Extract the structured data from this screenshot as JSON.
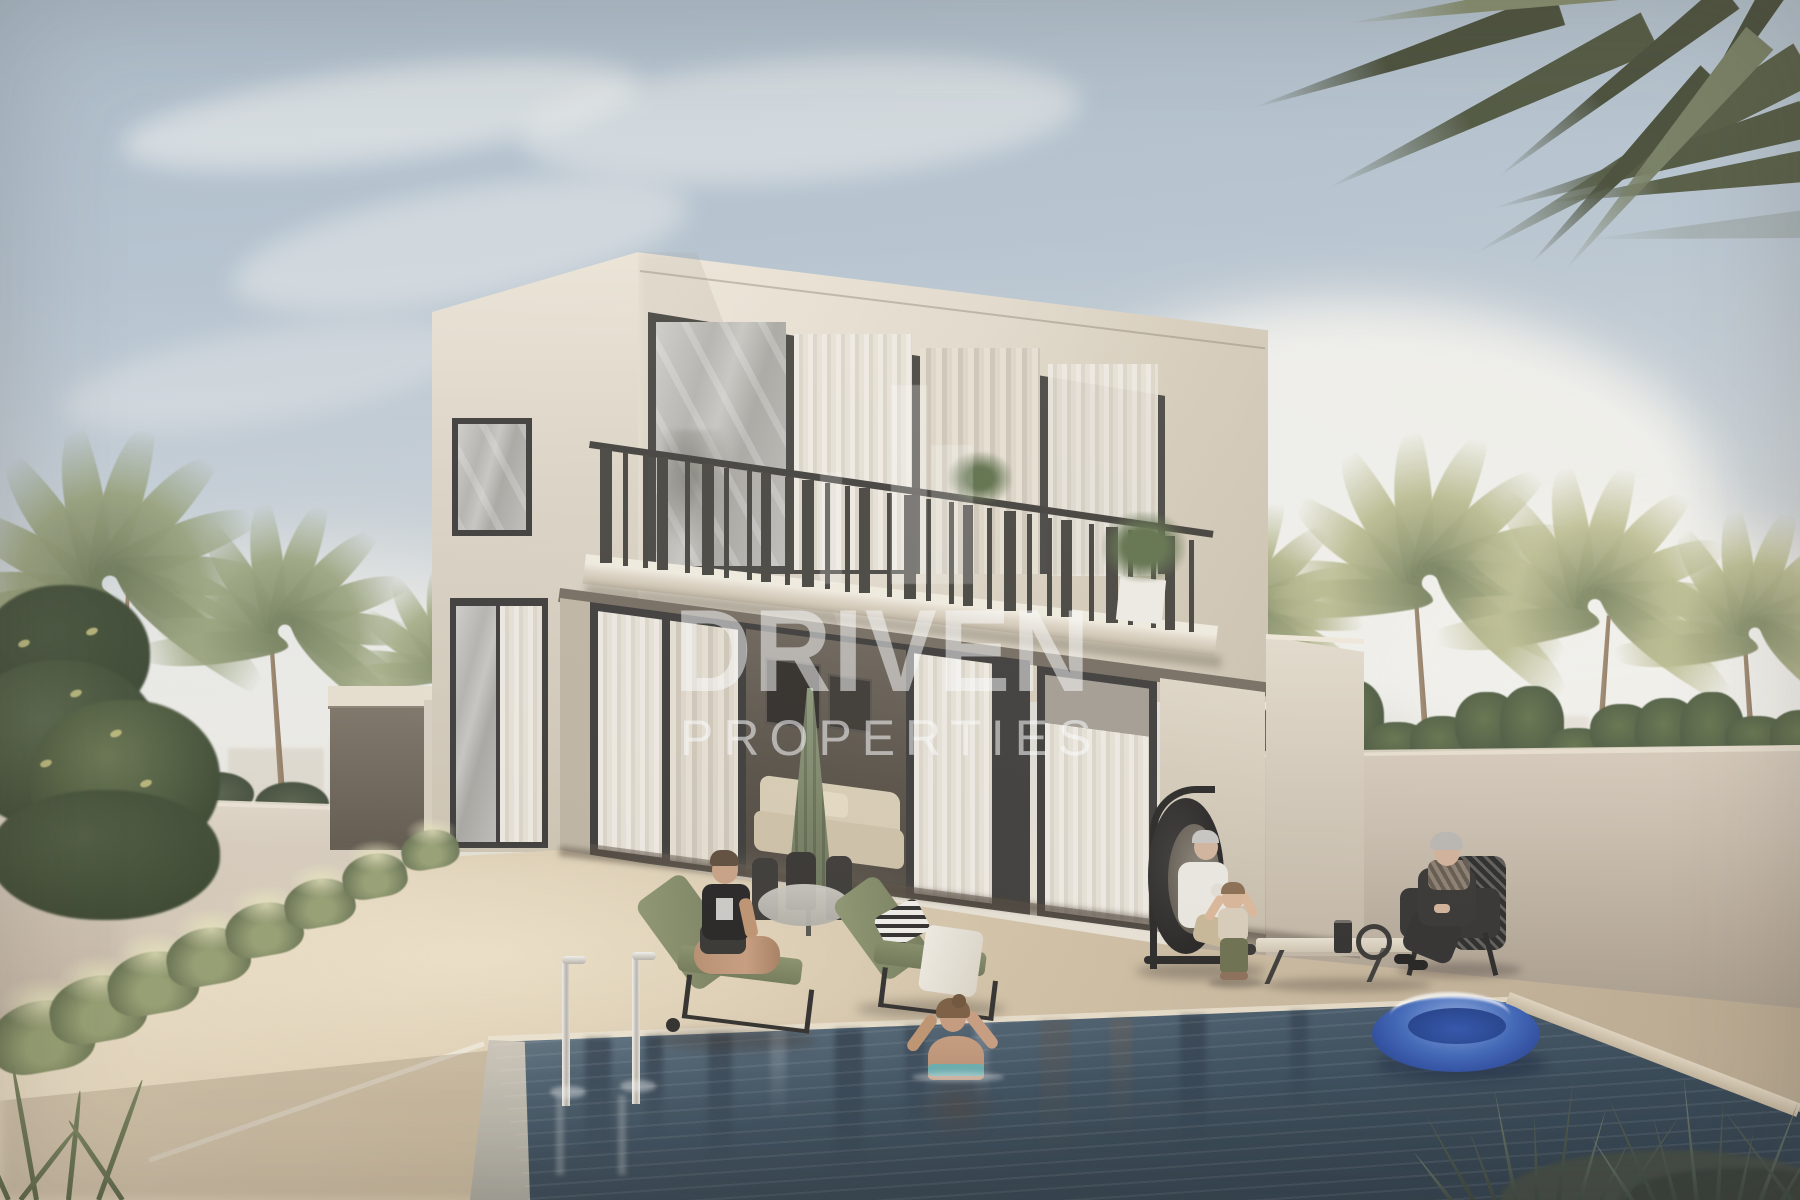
{
  "watermark": {
    "title": "DRIVEN",
    "subtitle": "PROPERTIES"
  },
  "palette": {
    "sky_top": "#a9bac9",
    "sky_horizon": "#e9e2d4",
    "cloud_white": "#f3f2ed",
    "facade_light": "#efe8da",
    "facade": "#e3dbcc",
    "facade_shadow": "#cdc2b0",
    "frame_dark": "#3b3936",
    "curtain": "#e9e3d7",
    "deck_light": "#ecdfc7",
    "deck": "#cdbca1",
    "deck_shadow": "#b3a288",
    "wall": "#c9bcab",
    "water_light": "#8fa0ab",
    "water": "#3a4c5b",
    "water_deep": "#253443",
    "palm": "#76815d",
    "palm_light": "#a6ab7f",
    "cushion_green": "#858c68",
    "float_blue": "#2c4da3",
    "watermark": "#ffffff",
    "skin": "#c99d7e"
  }
}
